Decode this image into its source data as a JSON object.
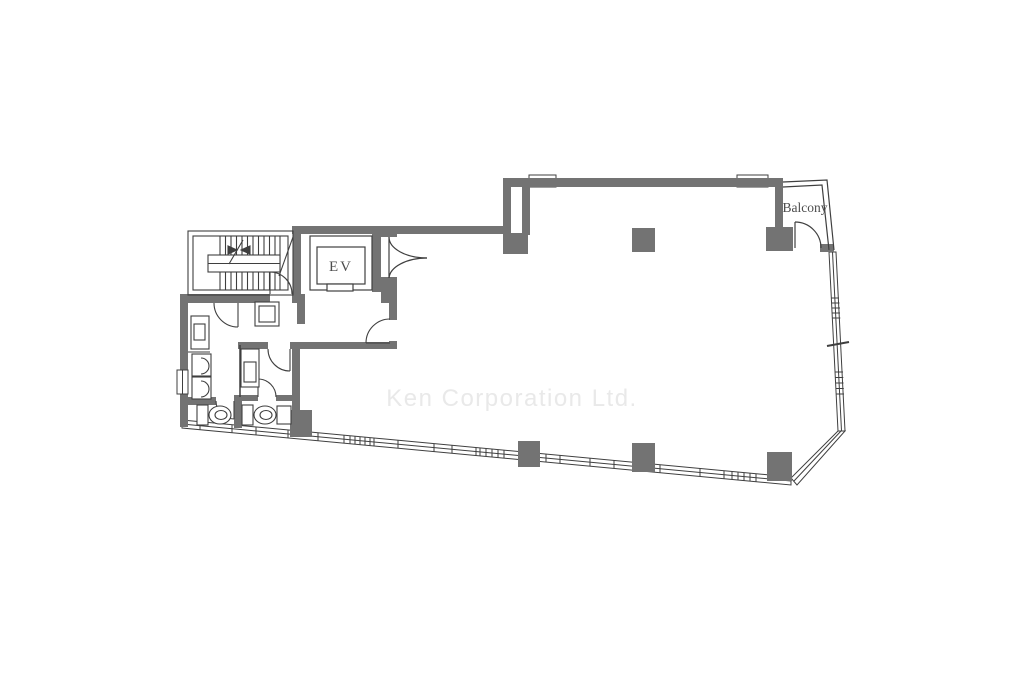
{
  "labels": {
    "elevator": "EV",
    "balcony": "Balcony",
    "watermark": "Ken Corporation Ltd."
  },
  "colors": {
    "wall": "#737373",
    "line": "#3f3f3f",
    "label_text": "#4d4d4d",
    "watermark_text": "#e9e9e9",
    "background": "#ffffff"
  }
}
